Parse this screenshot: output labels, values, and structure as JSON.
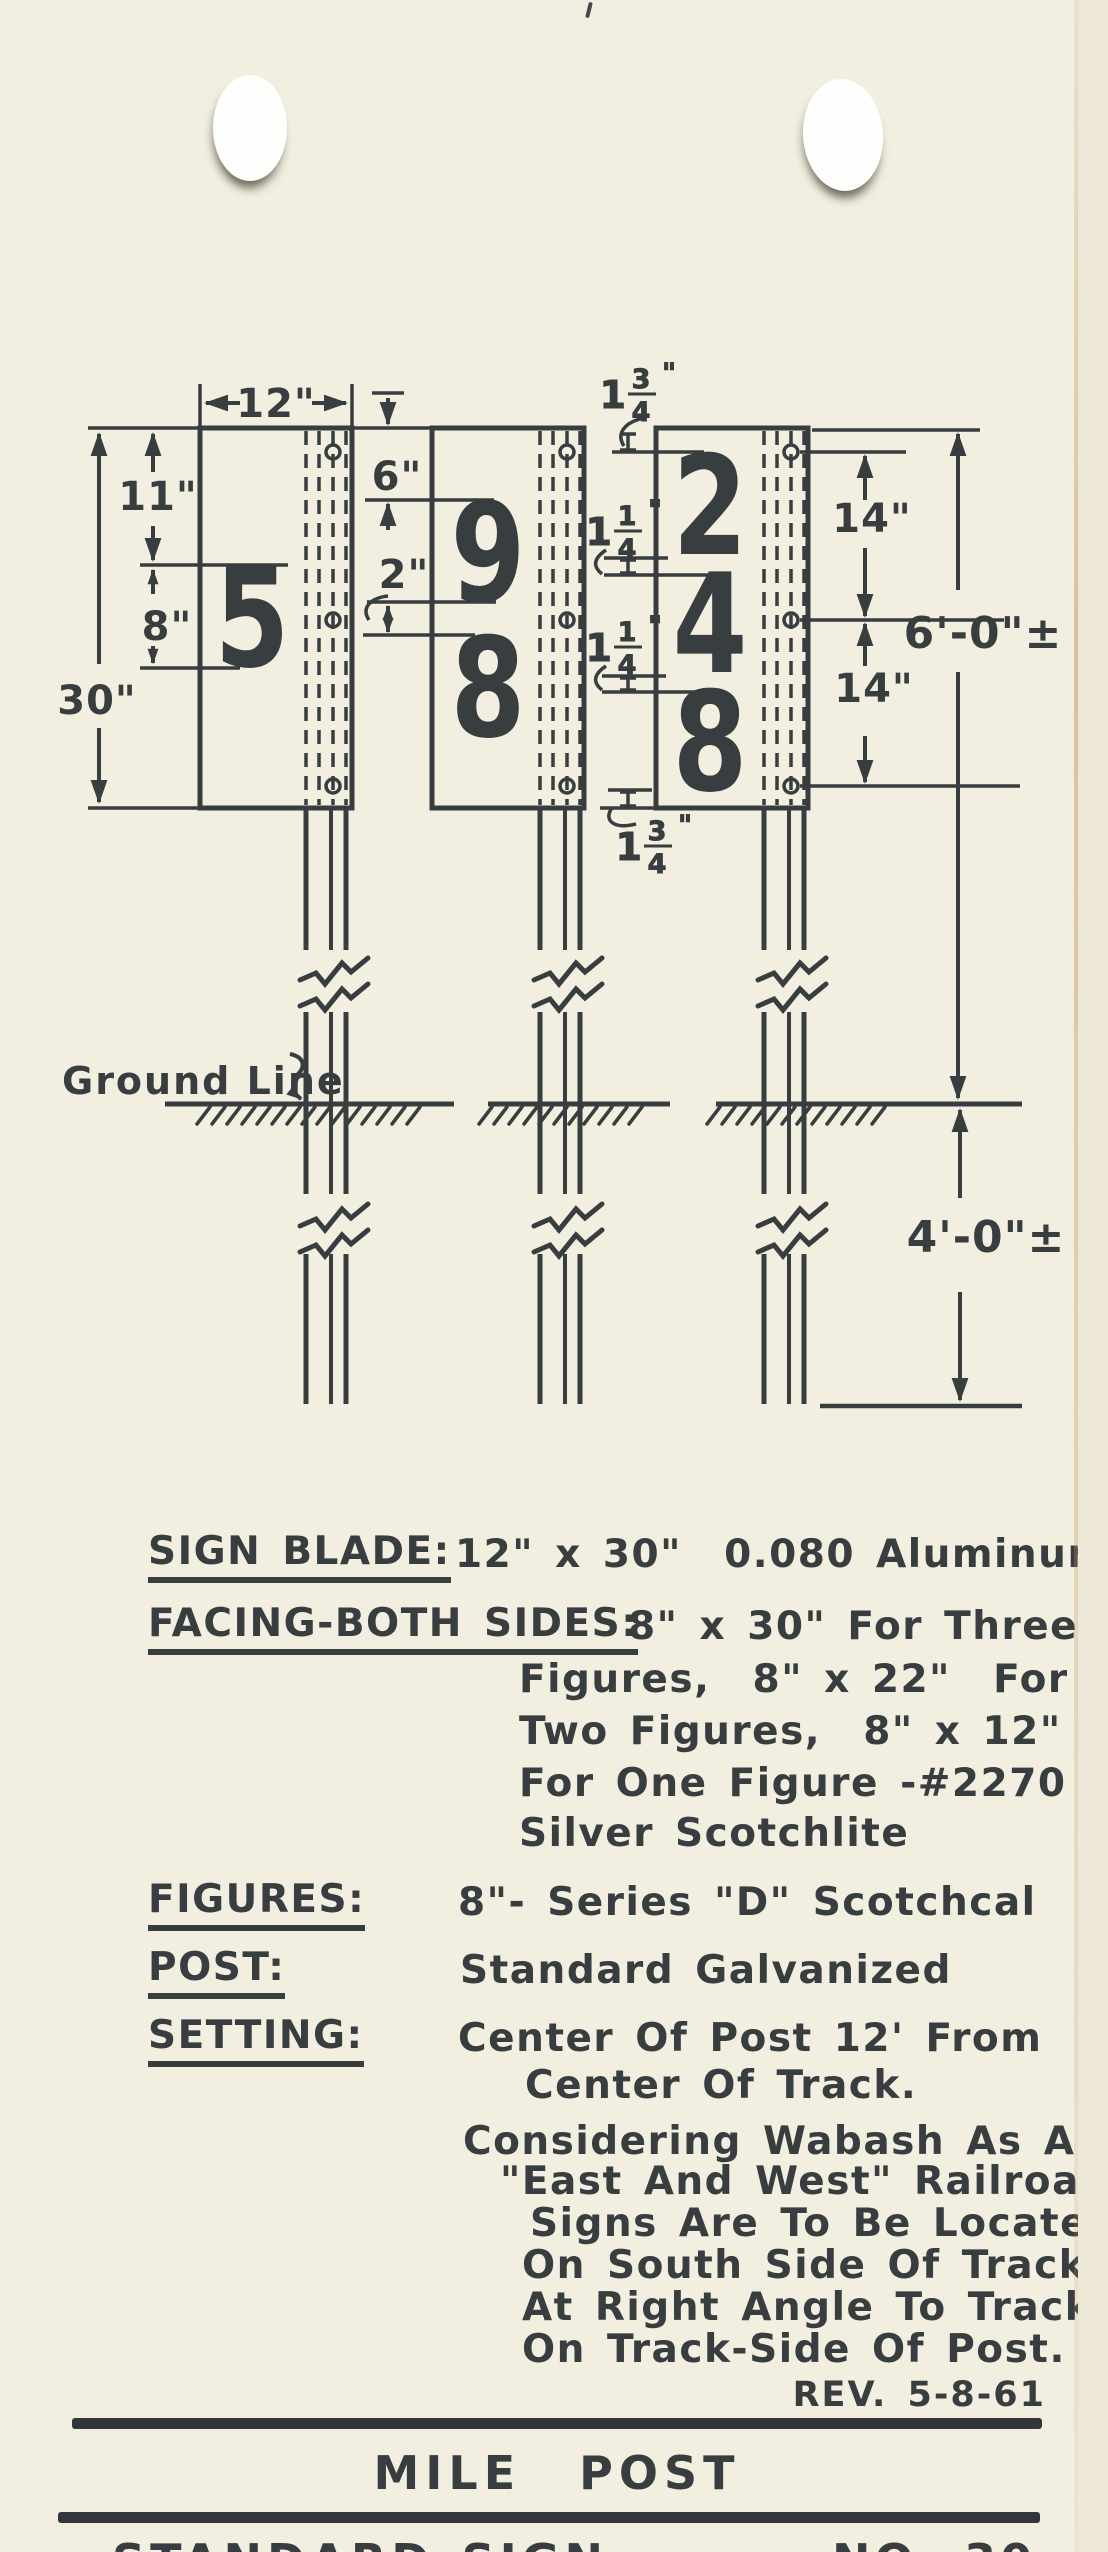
{
  "page": {
    "bg": "#f2eee0",
    "ink": "#383d3f"
  },
  "diagram": {
    "signs": [
      {
        "digits": [
          "5"
        ]
      },
      {
        "digits": [
          "9",
          "8"
        ]
      },
      {
        "digits": [
          "2",
          "4",
          "8"
        ]
      }
    ],
    "dims": {
      "blade_width": "12\"",
      "top_margin": "11\"",
      "figure_height": "8\"",
      "blade_height": "30\"",
      "mid_top_margin": "6\"",
      "mid_gap": "2\"",
      "bolt_upper": "14\"",
      "bolt_lower": "14\"",
      "height_above_ground": "6'-0\"±",
      "depth_below_ground": "4'-0\"±"
    },
    "fractions": {
      "top": {
        "whole": "1",
        "num": "3",
        "den": "4",
        "unit": "\""
      },
      "gap1": {
        "whole": "1",
        "num": "1",
        "den": "4",
        "unit": "\""
      },
      "gap2": {
        "whole": "1",
        "num": "1",
        "den": "4",
        "unit": "\""
      },
      "bottom": {
        "whole": "1",
        "num": "3",
        "den": "4",
        "unit": "\""
      }
    },
    "ground_label": "Ground Line"
  },
  "specs": {
    "sign_blade": {
      "label": "SIGN BLADE:",
      "value": "12\" x 30\"  0.080 Aluminum"
    },
    "facing": {
      "label": "FACING-BOTH SIDES:",
      "value": "8\" x 30\" For Three",
      "cont1": "Figures,  8\" x 22\"  For",
      "cont2": "Two Figures,  8\" x 12\"",
      "cont3": "For One Figure -#2270",
      "cont4": "Silver Scotchlite"
    },
    "figures": {
      "label": "FIGURES:",
      "value": "8\"- Series \"D\" Scotchcal"
    },
    "post": {
      "label": "POST:",
      "value": "Standard Galvanized"
    },
    "setting": {
      "label": "SETTING:",
      "value": "Center Of Post 12' From",
      "cont1": "Center Of Track."
    },
    "note1": "Considering Wabash As An",
    "note2": "\"East And West\" Railroad,",
    "note3": "Signs Are To Be Located",
    "note4": "On South Side Of Track",
    "note5": "At Right Angle To Track",
    "note6": "On Track-Side Of Post."
  },
  "footer": {
    "rev": "REV. 5-8-61",
    "title": "MILE POST",
    "left": "STANDARD SIGN",
    "right": "NO. 30"
  }
}
